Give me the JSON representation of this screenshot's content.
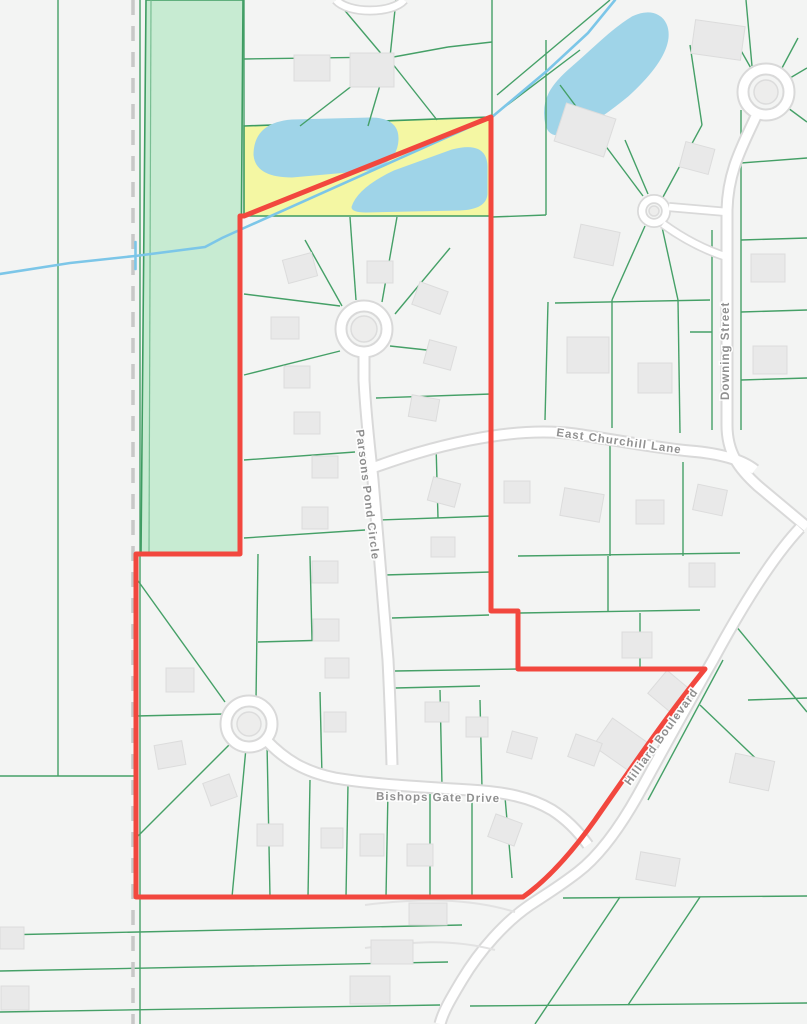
{
  "map": {
    "type": "municipal-parcel-map",
    "street_labels": {
      "east_churchill": "East Churchill Lane",
      "downing": "Downing Street",
      "parsons": "Parsons Pond Circle",
      "bishops": "Bishops Gate Drive",
      "hilliard": "Hilliard Boulevard"
    },
    "features": {
      "selection_boundary": "red outlined subdivision boundary",
      "highlight_parcel": "yellow highlighted pond parcel",
      "green_space": "green open-space strip",
      "ponds": "three ponds",
      "stream": "stream line",
      "municipal_line": "dashed gray boundary line"
    },
    "colors": {
      "background": "#f3f4f3",
      "parcel_line": "#45a067",
      "green_space": "#c7ebd2",
      "highlight_parcel": "#f4f7a3",
      "water": "#9fd4e8",
      "stream": "#7cc6e8",
      "selection_boundary": "#f2473e",
      "road_fill": "#ffffff",
      "road_casing": "#d9d9d9",
      "building": "#e9e9e9",
      "dashed_line": "#c8c8c8",
      "label_text": "#8b8b8b"
    }
  }
}
